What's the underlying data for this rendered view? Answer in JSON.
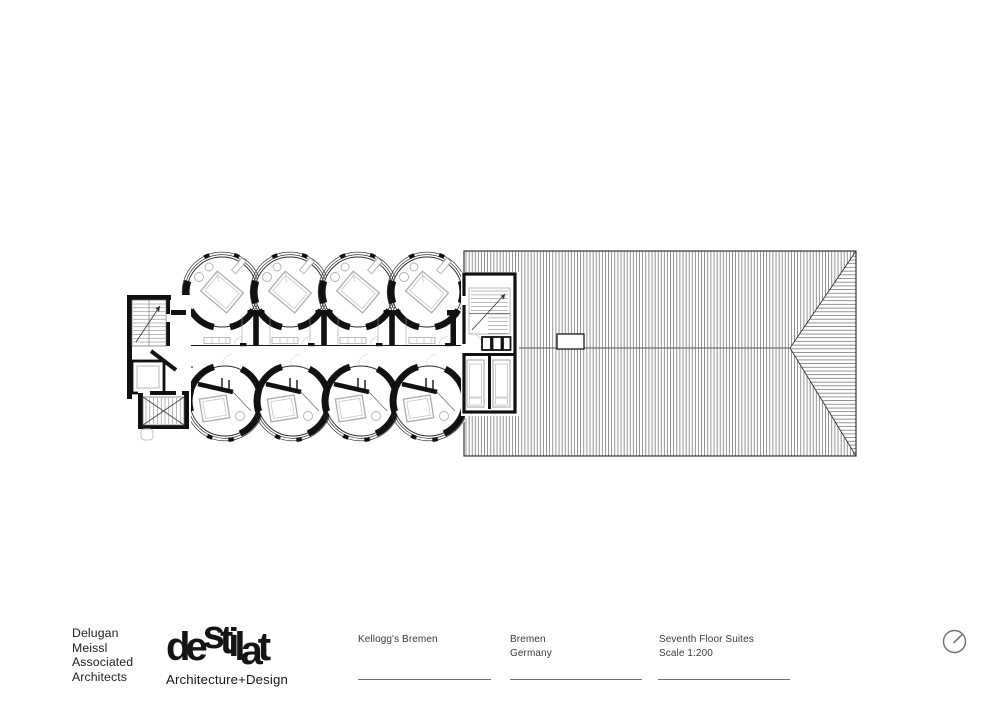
{
  "title_block": {
    "architect_lines": [
      "Delugan",
      "Meissl",
      "Associated",
      "Architects"
    ],
    "logo": {
      "letters": [
        "d",
        "e",
        "s",
        "t",
        "i",
        "l",
        "a",
        "t"
      ],
      "tagline": "Architecture+Design"
    },
    "project": "Kellogg's Bremen",
    "location_lines": [
      "Bremen",
      "Germany"
    ],
    "sheet_lines": [
      "Seventh Floor Suites",
      "Scale 1:200"
    ],
    "north_icon": "north-indicator"
  },
  "drawing": {
    "type": "architectural-floor-plan",
    "subject": "Seventh floor plan: eight circular hotel suites in two rows, central corridor, two stair cores, adjoining hatched hip roof",
    "scale": "1:200",
    "colors": {
      "ink": "#111111",
      "hatch": "#3d3d3d",
      "furniture_gray": "#b0b0b0",
      "rule_gray": "#707070"
    }
  }
}
